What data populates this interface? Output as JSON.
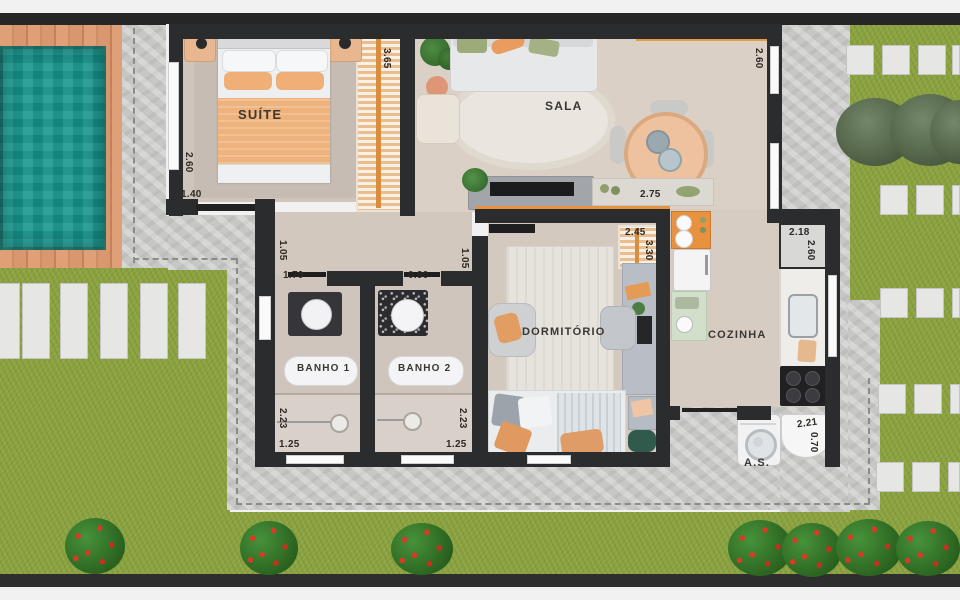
{
  "plan": {
    "rooms": {
      "suite": {
        "label": "SUÍTE",
        "closet_width": "3.10",
        "closet_depth": "3.65",
        "side": "2.60",
        "door": "1.40"
      },
      "sala": {
        "label": "SALA",
        "width": "5.05",
        "depth": "2.60",
        "console": "2.75"
      },
      "hall": {
        "left": "1.05",
        "banho1_door": "1.70",
        "banho2_door": "0.90",
        "right": "1.05"
      },
      "banho1": {
        "label": "BANHO 1",
        "depth": "2.23",
        "width": "1.25"
      },
      "banho2": {
        "label": "BANHO 2",
        "depth": "2.23",
        "width": "1.25"
      },
      "dormitorio": {
        "label": "DORMITÓRIO",
        "closet": "2.45",
        "depth": "3.30"
      },
      "cozinha": {
        "label": "COZINHA",
        "width": "2.18",
        "depth": "2.60"
      },
      "area_servico": {
        "label": "A.S.",
        "width": "2.21",
        "depth": "0.70"
      }
    },
    "palette": {
      "wall": "#2b2c2e",
      "pool_water": "#17978e",
      "deck_wood": "#dca078",
      "grass": "#8ca341",
      "concrete": "#c7c8c6",
      "warm_floor": "#d3c8be",
      "accent_orange": "#e8923f",
      "bush_green": "#2f6e28",
      "flower_red": "#d93a27"
    }
  }
}
